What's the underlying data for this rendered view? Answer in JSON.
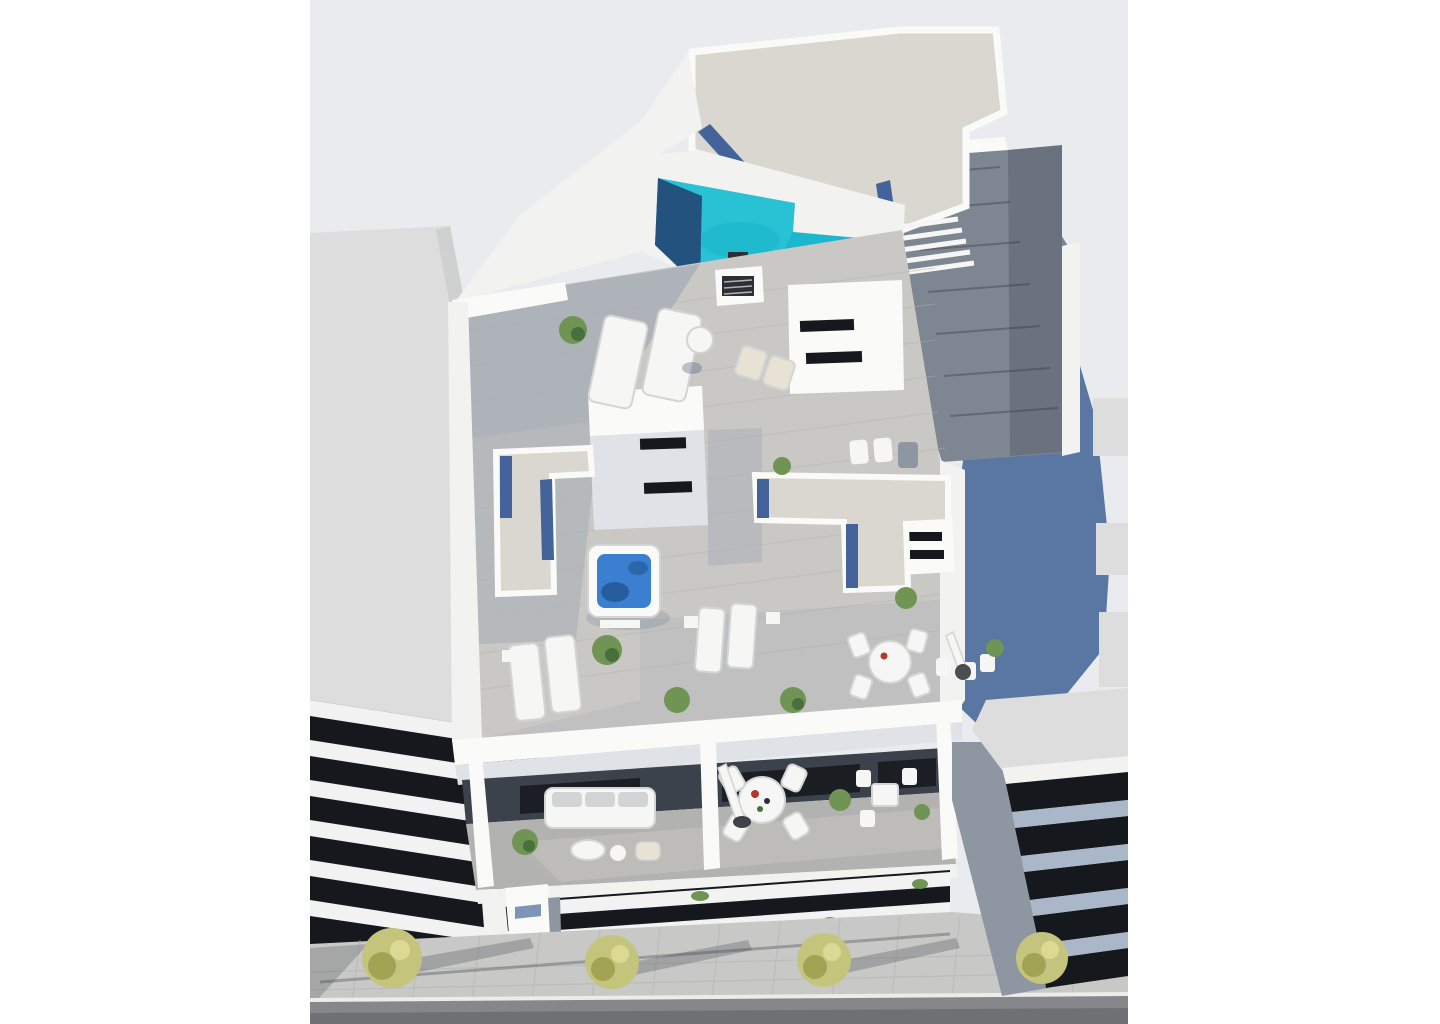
{
  "meta": {
    "kind": "architectural-3d-render",
    "view": "aerial-top-down",
    "subject": "apartment building rooftop with pool and terraces"
  },
  "colors": {
    "page_bg": "#ffffff",
    "sky": "#e9ebee",
    "neighbor_wall": "#dcddDC",
    "neighbor_wall_dark": "#cfd0d0",
    "white_wall": "#f2f2f0",
    "white_wall_bright": "#fafaf8",
    "wall_shade": "#dfe2e6",
    "gravel": "#d9d7cf",
    "gravel_strip": "#44639b",
    "pool_water": "#29c1d4",
    "pool_water_dark": "#12aec6",
    "pool_navy": "#24527e",
    "deck_light": "#cac8c4",
    "deck_mid": "#b2b2b0",
    "deck_shadow": "#919dae",
    "deck_dark_wood": "#7e8691",
    "stair_wood": "#6a7280",
    "blue_wall": "#5a77a4",
    "dark_void": "#15181d",
    "interior_shadow": "#3c424b",
    "facade_band": "#f1f2f1",
    "facade_band_blue": "#aab7c9",
    "glass_blue": "#7e95b8",
    "column_gray": "#8e96a1",
    "sidewalk": "#c8c8c6",
    "sidewalk_line": "#b2b2b0",
    "road": "#85878a",
    "road_dark": "#6e7073",
    "curb": "#ececea",
    "tree_yellow": "#c5c47c",
    "tree_yellow_dark": "#a3a356",
    "tree_highlight": "#dcd995",
    "plant_green": "#6f9454",
    "plant_green_dark": "#49703c",
    "furniture_white": "#f6f6f4",
    "furniture_shadow": "#d2d4d5",
    "seat_tan": "#e8e2d4",
    "jacuzzi_water": "#3b7fd0",
    "jacuzzi_dark": "#1d4f8a",
    "object_dark": "#2c3036",
    "shadow_soft": "rgba(75,95,130,0.35)",
    "red_accent": "#b03a2e"
  },
  "scene": {
    "elements": [
      {
        "name": "rooftop-pool",
        "label": "L-shaped turquoise rooftop pool"
      },
      {
        "name": "gravel-roof",
        "label": "Speckled gravel flat roof"
      },
      {
        "name": "roof-stairs",
        "label": "Stairs to pool deck"
      },
      {
        "name": "upper-wood-deck",
        "label": "Dark wood stair deck"
      },
      {
        "name": "mid-roof-terrace",
        "label": "Gray plank roof terrace"
      },
      {
        "name": "skylight-room",
        "label": "White roof room with dark skylight slots"
      },
      {
        "name": "jacuzzi",
        "label": "Square hot tub with blue water"
      },
      {
        "name": "sun-loungers",
        "label": "White sun loungers with cushions"
      },
      {
        "name": "parasol",
        "label": "Folded white parasol"
      },
      {
        "name": "dining-set",
        "label": "Round white table with four chairs"
      },
      {
        "name": "balcony-sofa",
        "label": "White three-seat outdoor sofa"
      },
      {
        "name": "facade-balconies",
        "label": "Horizontal white balcony bands"
      },
      {
        "name": "neighbor-building-left",
        "label": "Gray neighbor building"
      },
      {
        "name": "neighbor-building-right",
        "label": "Gray neighbor building with angled bands"
      },
      {
        "name": "blue-side-wall",
        "label": "Shaded slate-blue side wall"
      },
      {
        "name": "sidewalk",
        "label": "Paved sidewalk with street trees"
      },
      {
        "name": "street-trees",
        "label": "Four yellow-green trees"
      },
      {
        "name": "road",
        "label": "Asphalt road with white curb"
      }
    ]
  }
}
